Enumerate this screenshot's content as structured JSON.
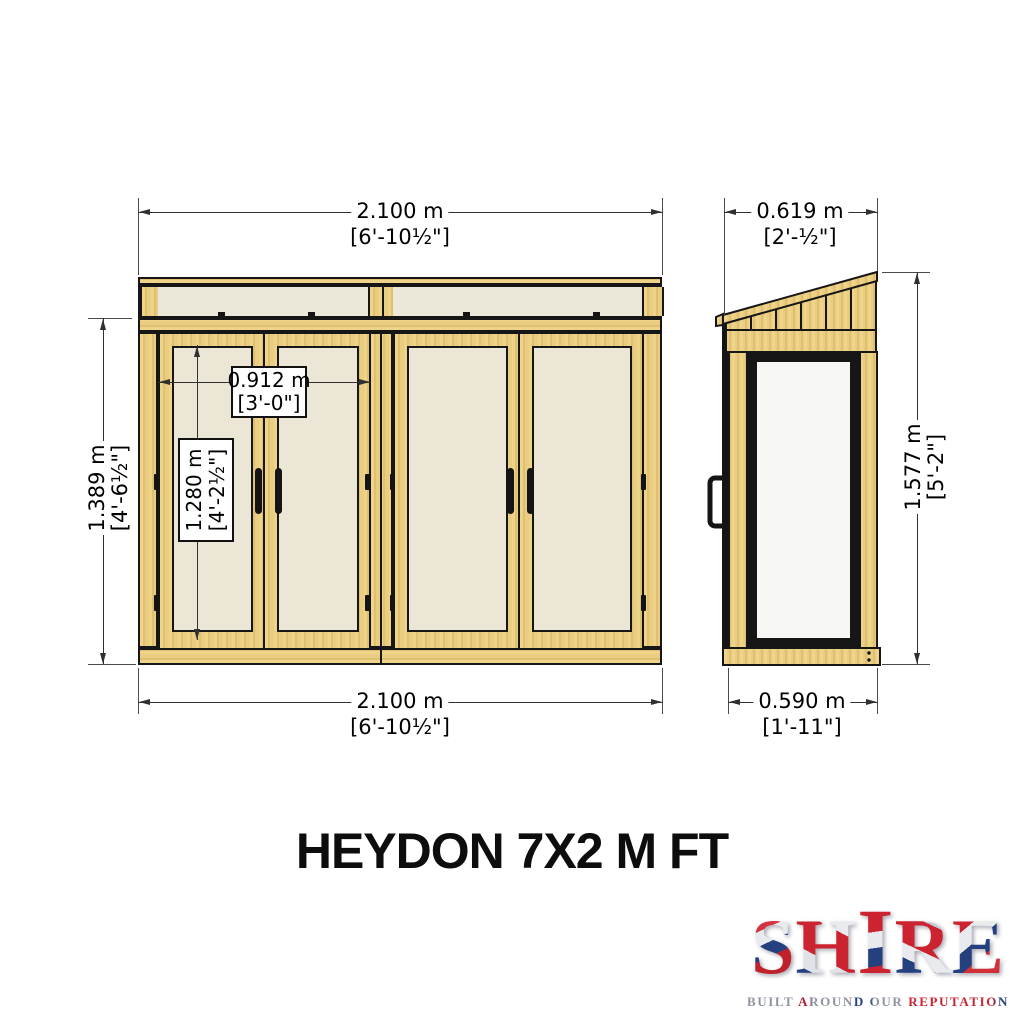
{
  "title": "HEYDON 7X2 M FT",
  "views": {
    "front": {
      "dim_width_top": {
        "metric": "2.100 m",
        "imperial": "[6'-10½\"]"
      },
      "dim_width_bottom": {
        "metric": "2.100 m",
        "imperial": "[6'-10½\"]"
      },
      "dim_height_left": {
        "metric": "1.389 m",
        "imperial": "[4'-6½\"]"
      },
      "dim_door_pair_width": {
        "metric": "0.912 m",
        "imperial": "[3'-0\"]"
      },
      "dim_door_height": {
        "metric": "1.280 m",
        "imperial": "[4'-2½\"]"
      }
    },
    "side": {
      "dim_depth_top": {
        "metric": "0.619 m",
        "imperial": "[2'-½\"]"
      },
      "dim_height_right": {
        "metric": "1.577 m",
        "imperial": "[5'-2\"]"
      },
      "dim_depth_bottom": {
        "metric": "0.590 m",
        "imperial": "[1'-11\"]"
      }
    }
  },
  "logo": {
    "name": "SHIRE",
    "tagline": "BUILT AROUND OUR REPUTATION"
  },
  "colors": {
    "wood": "#e9cd80",
    "wood_light": "#eed389",
    "wood_dark": "#dfc070",
    "panel_cream": "#ebe6d6",
    "side_glass": "#f7f7f4",
    "outline": "#161616",
    "dimension_line": "#303030",
    "logo_red": "#cc2330",
    "logo_blue": "#24407f",
    "logo_silver": "#c9ccd3"
  }
}
